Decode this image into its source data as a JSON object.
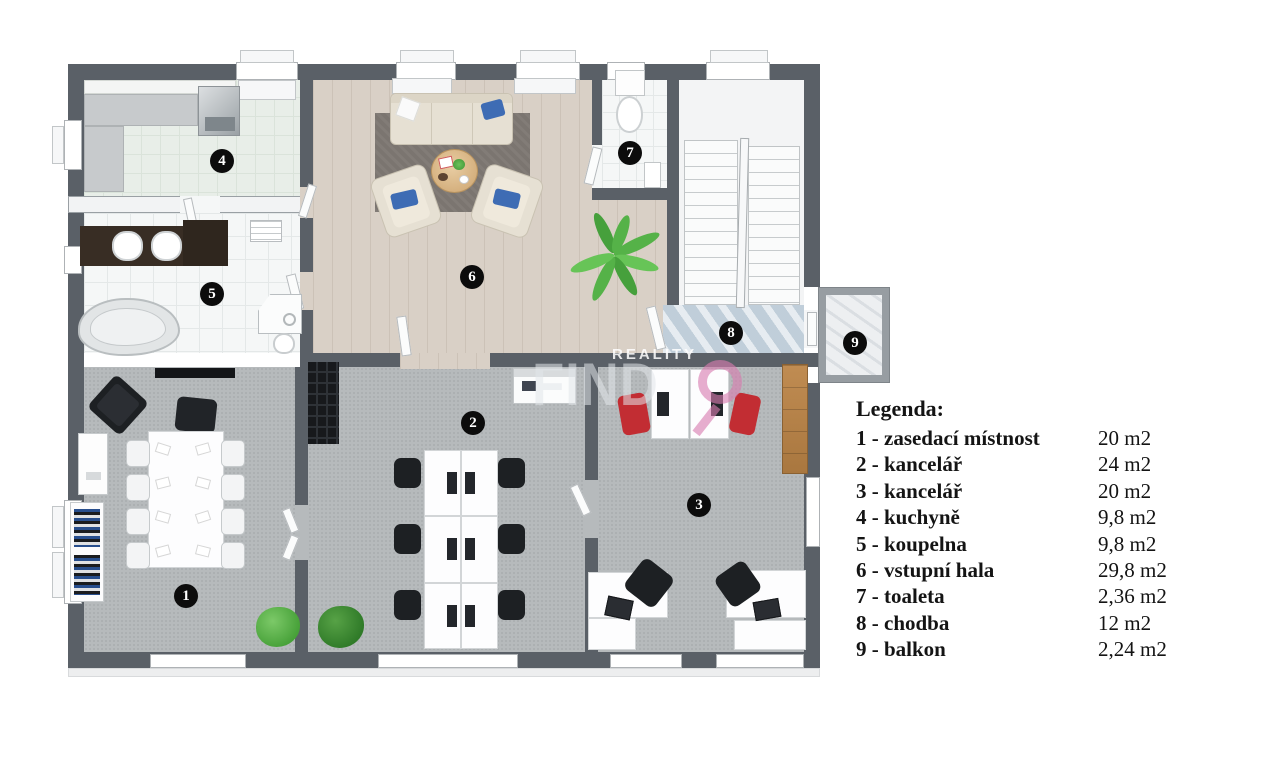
{
  "page": {
    "type": "floor-plan",
    "language": "cs"
  },
  "palette": {
    "wall": "#5a6067",
    "office_carpet": "#b6babc",
    "wood_floor": "#d9d0c6",
    "kitchen_tile": "#e8eee8",
    "bath_tile": "#f5f7f7",
    "corridor_marble": "#c9d6e0",
    "balcony_marble": "#edeff1",
    "rug": "#7b7570",
    "sofa_cream": "#e6e0d3",
    "pillow_blue": "#3e6cb4",
    "chair_black": "#1d2023",
    "chair_red": "#c22d33",
    "cabinet_wood": "#b5824a",
    "vanity_brown": "#382d24",
    "plant_green": "#5cb64e",
    "badge": "#0c0c0c",
    "watermark_pink": "#d97db0"
  },
  "legend": {
    "title": "Legenda:",
    "items": [
      {
        "label": "1 - zasedací místnost",
        "area": "20 m2"
      },
      {
        "label": "2 - kancelář",
        "area": "24 m2"
      },
      {
        "label": "3 - kancelář",
        "area": "20 m2"
      },
      {
        "label": "4 - kuchyně",
        "area": "9,8 m2"
      },
      {
        "label": "5 - koupelna",
        "area": "9,8 m2"
      },
      {
        "label": "6 - vstupní hala",
        "area": "29,8 m2"
      },
      {
        "label": "7 - toaleta",
        "area": "2,36 m2"
      },
      {
        "label": "8 - chodba",
        "area": "12 m2"
      },
      {
        "label": "9 - balkon",
        "area": "2,24 m2"
      }
    ]
  },
  "rooms": [
    {
      "number": "1",
      "name": "zasedací místnost"
    },
    {
      "number": "2",
      "name": "kancelář"
    },
    {
      "number": "3",
      "name": "kancelář"
    },
    {
      "number": "4",
      "name": "kuchyně"
    },
    {
      "number": "5",
      "name": "koupelna"
    },
    {
      "number": "6",
      "name": "vstupní hala"
    },
    {
      "number": "7",
      "name": "toaleta"
    },
    {
      "number": "8",
      "name": "chodba"
    },
    {
      "number": "9",
      "name": "balkon"
    }
  ],
  "watermark": {
    "line1": "REALITY",
    "line2": "FIND"
  }
}
